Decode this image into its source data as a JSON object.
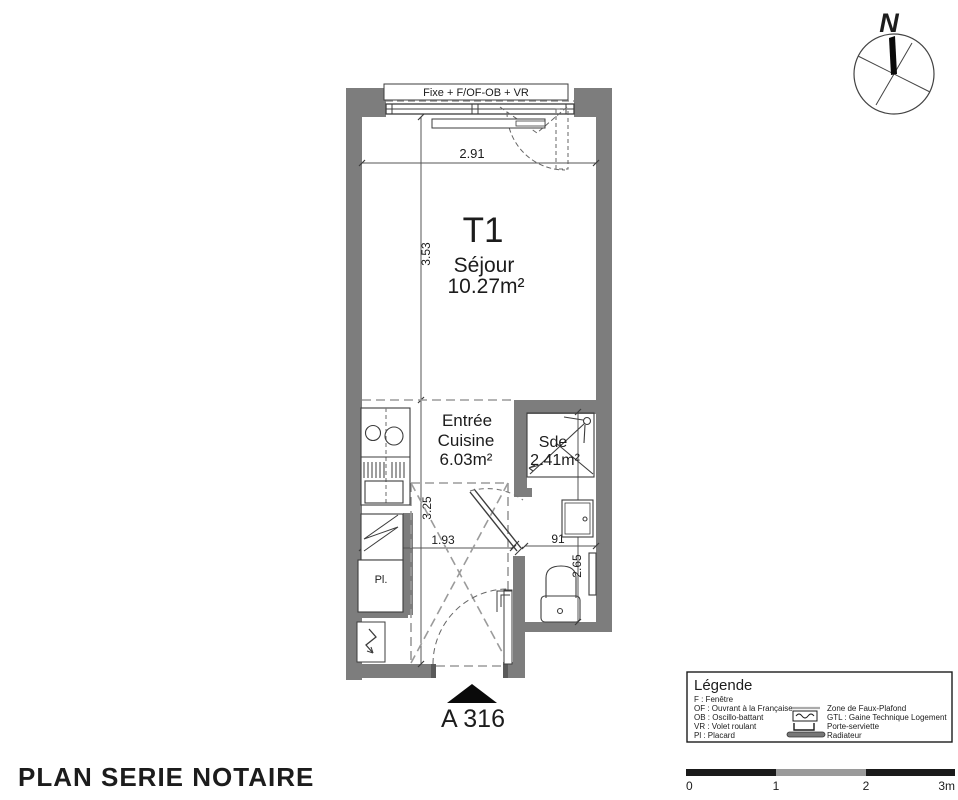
{
  "north": {
    "label": "N"
  },
  "plan": {
    "window_label": "Fixe + F/OF-OB + VR",
    "rooms": {
      "sejour": {
        "code": "T1",
        "name": "Séjour",
        "area": "10.27m²"
      },
      "entree": {
        "name_line1": "Entrée",
        "name_line2": "Cuisine",
        "area": "6.03m²"
      },
      "sde": {
        "name": "Sde",
        "area": "2.41m²"
      },
      "placard_label": "Pl."
    },
    "dimensions": {
      "width_top": "2.91",
      "sejour_depth": "3.53",
      "entree_depth": "3.25",
      "entree_width": "1.93",
      "wc_width": "91",
      "wc_depth": "2.65"
    },
    "unit_label": "A 316"
  },
  "legend": {
    "title": "Légende",
    "abbreviations": [
      "F : Fenêtre",
      "OF : Ouvrant à la Française",
      "OB : Oscillo-battant",
      "VR : Volet roulant",
      "Pl : Placard"
    ],
    "symbols": [
      "Zone de Faux-Plafond",
      "GTL : Gaine Technique Logement",
      "Porte-serviette",
      "Radiateur"
    ]
  },
  "scale_bar": {
    "tick_labels": [
      "0",
      "1",
      "2",
      "3m"
    ]
  },
  "footer": {
    "title": "PLAN SERIE NOTAIRE"
  },
  "colors": {
    "wall": "#7d7d7d",
    "line": "#3d3d3d",
    "dash": "#999999"
  }
}
